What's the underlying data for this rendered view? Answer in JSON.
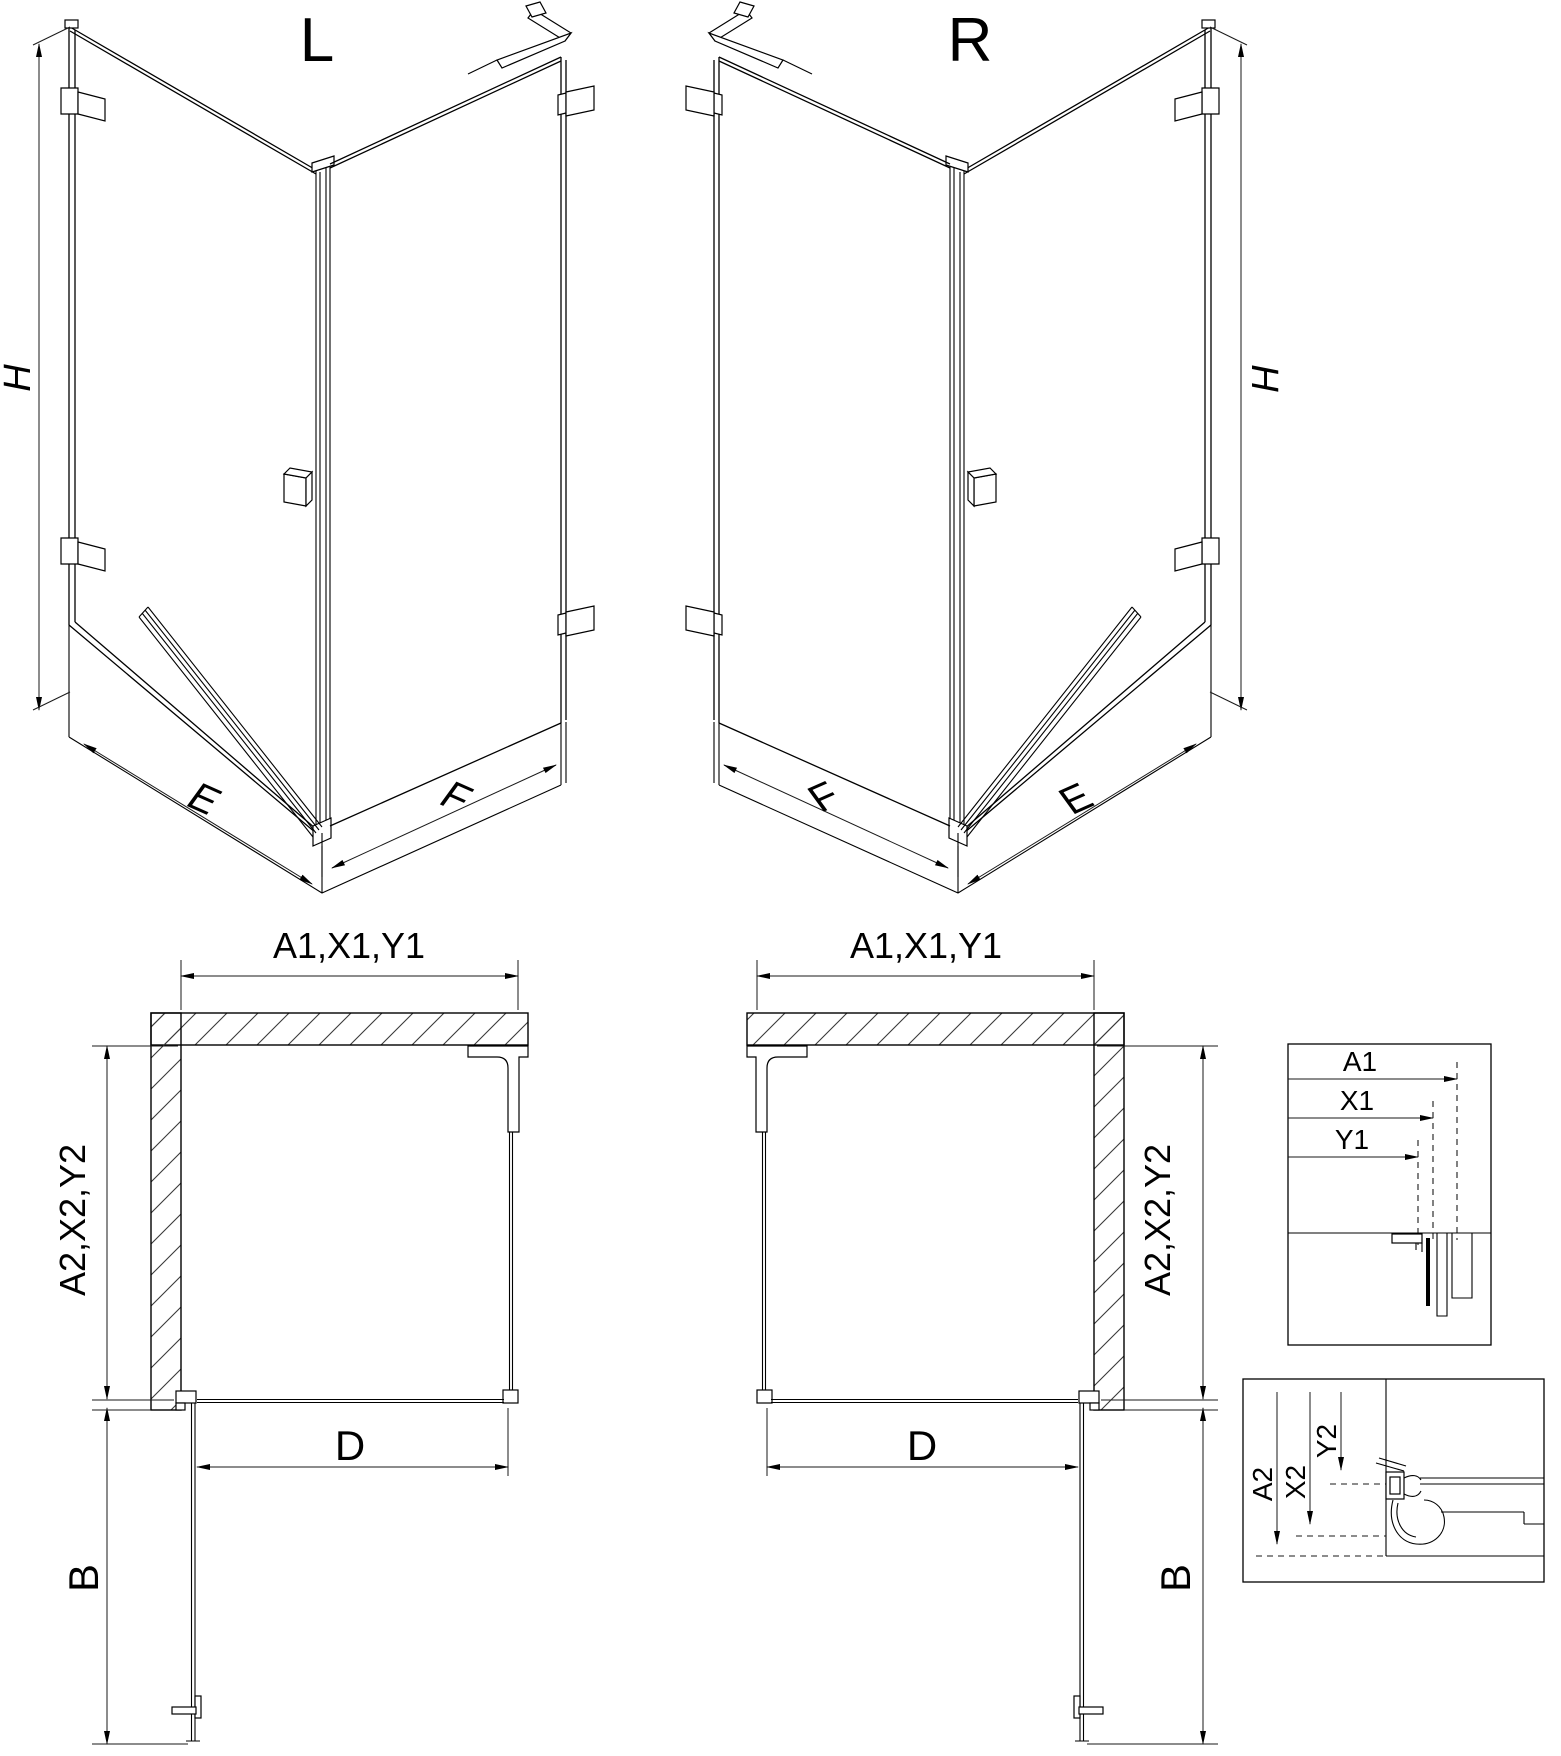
{
  "drawing": {
    "iso_left": {
      "title": "L",
      "height_label": "H",
      "bottom_left_label": "E",
      "bottom_right_label": "F"
    },
    "iso_right": {
      "title": "R",
      "height_label": "H",
      "bottom_left_label": "F",
      "bottom_right_label": "E"
    },
    "plan_left": {
      "top_width_label": "A1,X1,Y1",
      "depth_label": "A2,X2,Y2",
      "door_width_label": "D",
      "door_swing_label": "B"
    },
    "plan_right": {
      "top_width_label": "A1,X1,Y1",
      "depth_label": "A2,X2,Y2",
      "door_width_label": "D",
      "door_swing_label": "B"
    },
    "detail_top_offsets": {
      "a": "A1",
      "x": "X1",
      "y": "Y1"
    },
    "detail_bottom_offsets": {
      "a": "A2",
      "x": "X2",
      "y": "Y2"
    }
  },
  "colors": {
    "line": "#000000",
    "hatch": "#3a3a3a",
    "background": "#ffffff"
  }
}
